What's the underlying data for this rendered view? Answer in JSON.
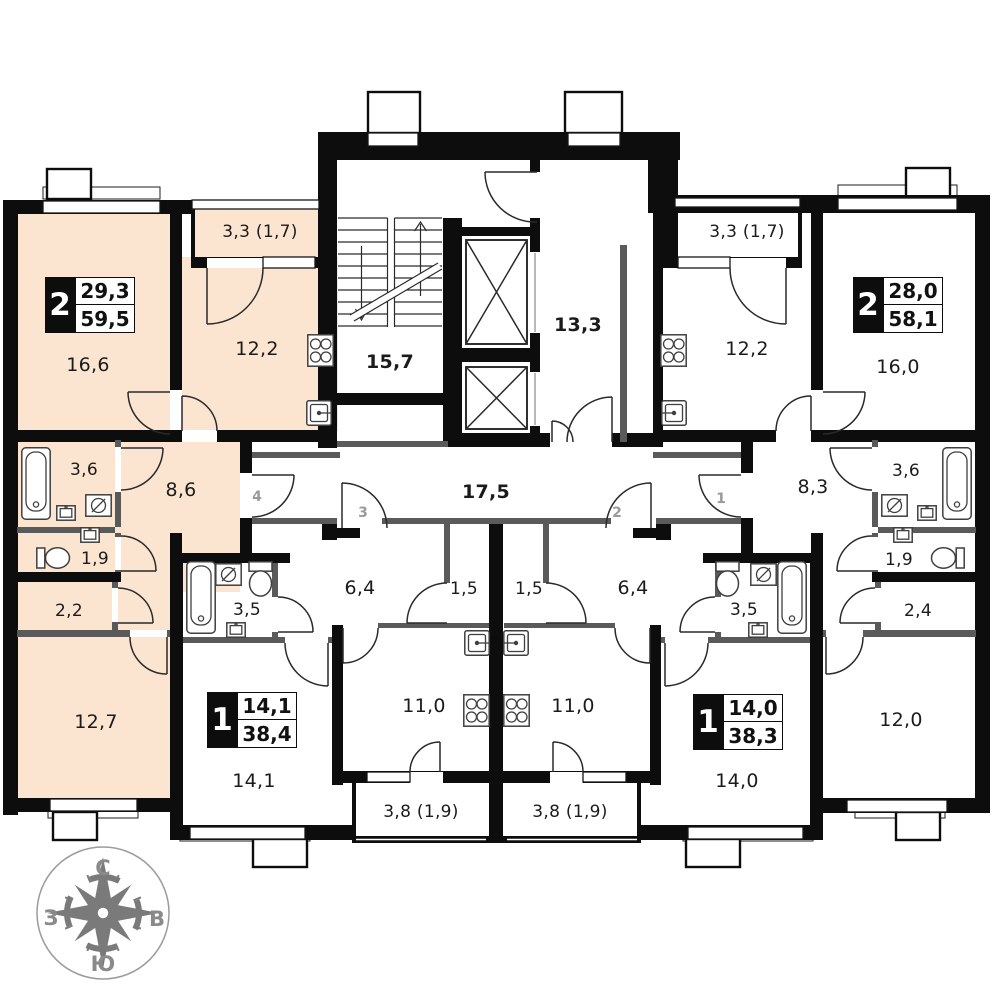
{
  "colors": {
    "wall": "#0d0d0d",
    "thin_wall": "#5a5a5a",
    "highlight_apartment": "#fbe5d0",
    "label": "#1b1b1b",
    "door_number": "#9a9a9a",
    "compass": "#7a7a7a"
  },
  "apartments": [
    {
      "id": "left-2room",
      "highlighted": true,
      "type_label": "2",
      "area_living": "29,3",
      "area_total": "59,5"
    },
    {
      "id": "right-2room",
      "highlighted": false,
      "type_label": "2",
      "area_living": "28,0",
      "area_total": "58,1"
    },
    {
      "id": "left-1room",
      "highlighted": false,
      "type_label": "1",
      "area_living": "14,1",
      "area_total": "38,4"
    },
    {
      "id": "right-1room",
      "highlighted": false,
      "type_label": "1",
      "area_living": "14,0",
      "area_total": "38,3"
    }
  ],
  "rooms": [
    {
      "text": "16,6"
    },
    {
      "text": "3,3 (1,7)"
    },
    {
      "text": "12,2"
    },
    {
      "text": "15,7"
    },
    {
      "text": "13,3"
    },
    {
      "text": "3,3 (1,7)"
    },
    {
      "text": "12,2"
    },
    {
      "text": "16,0"
    },
    {
      "text": "3,6"
    },
    {
      "text": "8,6"
    },
    {
      "text": "17,5"
    },
    {
      "text": "8,3"
    },
    {
      "text": "3,6"
    },
    {
      "text": "1,9"
    },
    {
      "text": "1,9"
    },
    {
      "text": "2,2"
    },
    {
      "text": "3,5"
    },
    {
      "text": "6,4"
    },
    {
      "text": "1,5"
    },
    {
      "text": "1,5"
    },
    {
      "text": "6,4"
    },
    {
      "text": "3,5"
    },
    {
      "text": "2,4"
    },
    {
      "text": "12,7"
    },
    {
      "text": "11,0"
    },
    {
      "text": "11,0"
    },
    {
      "text": "12,0"
    },
    {
      "text": "14,1"
    },
    {
      "text": "14,0"
    },
    {
      "text": "3,8 (1,9)"
    },
    {
      "text": "3,8 (1,9)"
    }
  ],
  "door_numbers": [
    {
      "text": "4"
    },
    {
      "text": "3"
    },
    {
      "text": "2"
    },
    {
      "text": "1"
    }
  ],
  "compass": {
    "north": "С",
    "east": "В",
    "south": "Ю",
    "west": "З"
  },
  "icons": [
    "bathtub-icon",
    "toilet-icon",
    "sink-icon",
    "washing-machine-icon",
    "stove-icon",
    "kitchen-sink-icon",
    "elevator-icon",
    "stairs-icon",
    "compass-rose-icon"
  ]
}
